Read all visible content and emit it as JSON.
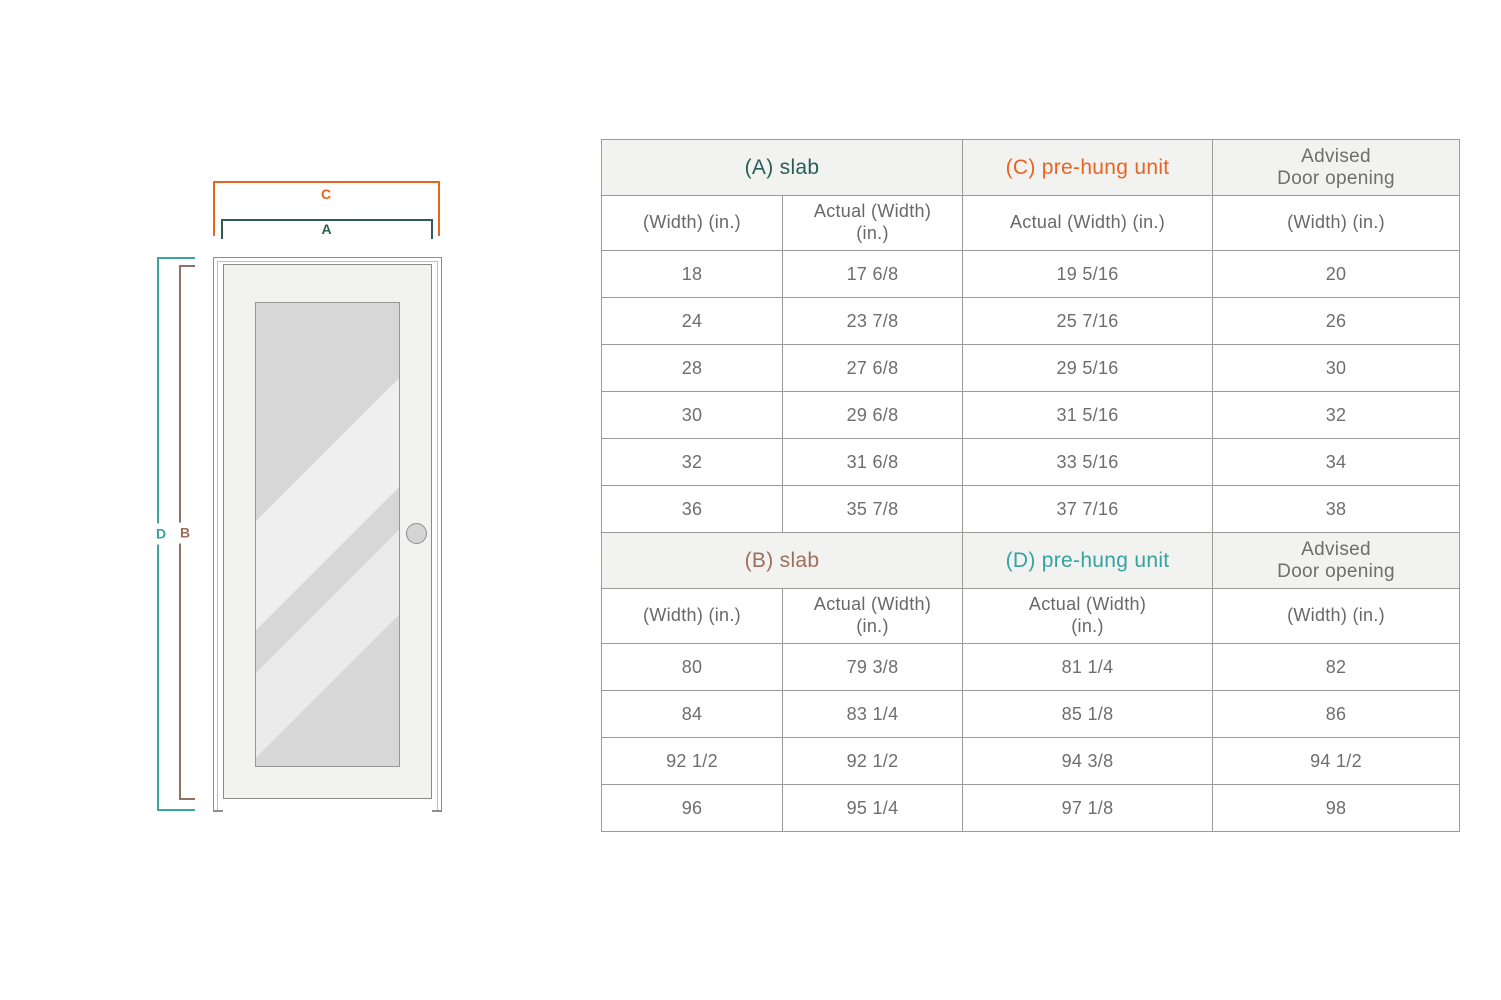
{
  "diagram": {
    "labels": {
      "c": "C",
      "a": "A",
      "d": "D",
      "b": "B"
    },
    "colors": {
      "c": "#e8641f",
      "a": "#2f5d56",
      "d": "#34a3a1",
      "b": "#9c6f5a"
    },
    "parts": {
      "frame": "door-frame",
      "slab": "door-slab",
      "glass": "glass-panel",
      "knob": "door-knob"
    }
  },
  "table": {
    "border_color": "#9b9b9b",
    "header_bg": "#f2f2f0",
    "text_color": "#6e6e6e",
    "sections": [
      {
        "headers": [
          {
            "text": "(A) slab",
            "color": "#275e56"
          },
          {
            "text": "(C) pre-hung unit",
            "color": "#e8641f"
          },
          {
            "text": "Advised\nDoor opening",
            "color": "#6e6e6e"
          }
        ],
        "subheaders": [
          "(Width) (in.)",
          "Actual (Width)\n(in.)",
          "Actual (Width) (in.)",
          "(Width) (in.)"
        ],
        "rows": [
          [
            "18",
            "17 6/8",
            "19 5/16",
            "20"
          ],
          [
            "24",
            "23 7/8",
            "25 7/16",
            "26"
          ],
          [
            "28",
            "27 6/8",
            "29 5/16",
            "30"
          ],
          [
            "30",
            "29 6/8",
            "31 5/16",
            "32"
          ],
          [
            "32",
            "31 6/8",
            "33 5/16",
            "34"
          ],
          [
            "36",
            "35 7/8",
            "37 7/16",
            "38"
          ]
        ]
      },
      {
        "headers": [
          {
            "text": "(B) slab",
            "color": "#9c6f5a"
          },
          {
            "text": "(D) pre-hung unit",
            "color": "#34a3a1"
          },
          {
            "text": "Advised\nDoor opening",
            "color": "#6e6e6e"
          }
        ],
        "subheaders": [
          "(Width) (in.)",
          "Actual (Width)\n(in.)",
          "Actual (Width)\n(in.)",
          "(Width) (in.)"
        ],
        "rows": [
          [
            "80",
            "79 3/8",
            "81 1/4",
            "82"
          ],
          [
            "84",
            "83 1/4",
            "85 1/8",
            "86"
          ],
          [
            "92 1/2",
            "92 1/2",
            "94 3/8",
            "94 1/2"
          ],
          [
            "96",
            "95 1/4",
            "97 1/8",
            "98"
          ]
        ]
      }
    ]
  }
}
